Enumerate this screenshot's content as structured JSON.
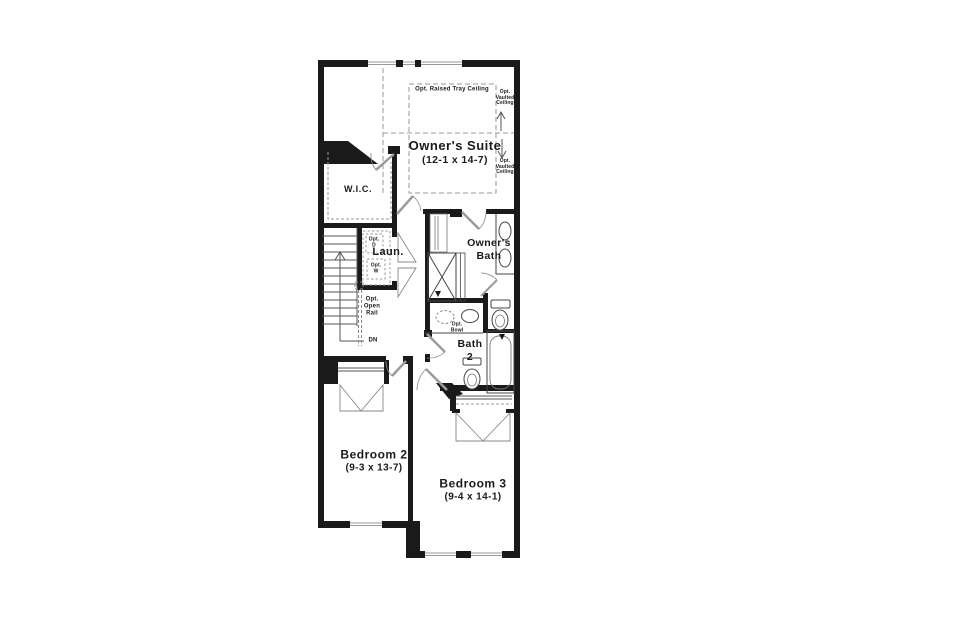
{
  "colors": {
    "wall": "#1a1a1a",
    "thin_line": "#4a4a4a",
    "door": "#9b9b9b",
    "dash": "#9a9a9a",
    "background": "#ffffff"
  },
  "rooms": {
    "owners_suite": {
      "name": "Owner's Suite",
      "dims": "(12-1 x 14-7)"
    },
    "wic": {
      "name": "W.I.C."
    },
    "laundry": {
      "name": "Laun.",
      "opt_dryer_l1": "Opt.",
      "opt_dryer_l2": "D",
      "opt_washer_l1": "Opt.",
      "opt_washer_l2": "W"
    },
    "owners_bath": {
      "name_l1": "Owner's",
      "name_l2": "Bath"
    },
    "bath2": {
      "name_l1": "Bath",
      "name_l2": "2",
      "opt_bowl_l1": "Opt.",
      "opt_bowl_l2": "Bowl"
    },
    "bedroom2": {
      "name": "Bedroom 2",
      "dims": "(9-3 x 13-7)"
    },
    "bedroom3": {
      "name": "Bedroom 3",
      "dims": "(9-4 x 14-1)"
    }
  },
  "annotations": {
    "tray_ceiling": "Opt. Raised Tray Ceiling",
    "vaulted_top_l1": "Opt.",
    "vaulted_top_l2": "Vaulted",
    "vaulted_top_l3": "Ceiling",
    "vaulted_bottom_l1": "Opt.",
    "vaulted_bottom_l2": "Vaulted",
    "vaulted_bottom_l3": "Ceiling",
    "open_rail_l1": "Opt.",
    "open_rail_l2": "Open",
    "open_rail_l3": "Rail",
    "stairs_down": "DN"
  }
}
